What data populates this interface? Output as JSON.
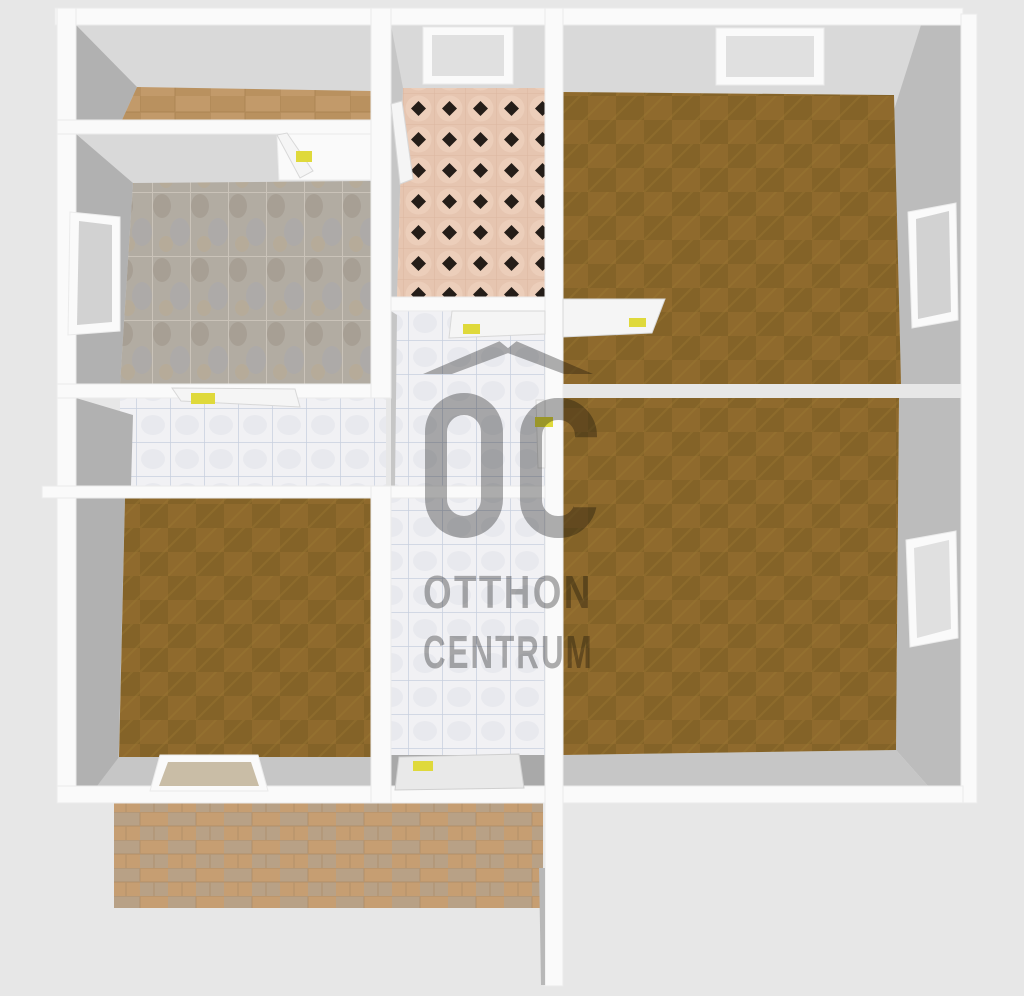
{
  "watermark": {
    "logo_text": "OC",
    "line1": "OTTHON",
    "line2": "CENTRUM"
  },
  "palette": {
    "bg": "#e7e7e7",
    "wall": "#fafafa",
    "face_light": "#d9d9d9",
    "face_mid": "#c6c6c6",
    "face_side": "#bcbcbc",
    "face_dark": "#b1b1b1",
    "wood_base": "#8f6a2d",
    "wood_dark": "#806027",
    "wood_hatch": "#9c7733",
    "woodlight_base": "#c29a6a",
    "woodlight_dark": "#b38a58",
    "woodlight_line": "#a8814f",
    "terrace_base": "#c69e72",
    "terrace_alt": "#b7a289",
    "terrace_line": "#a98a63",
    "kitchen_base": "#b2aca2",
    "kitchen_blob1": "#9e9488",
    "kitchen_blob2": "#a8a8ae",
    "kitchen_blob3": "#baa98f",
    "kitchen_grout": "#cdc6bc",
    "bath_base": "#e6c5b0",
    "bath_shade": "#f0d4c2",
    "bath_diamond": "#241d18",
    "bath_grout": "#d8b19b",
    "hall_base": "#f1f1f4",
    "hall_blob": "#e3e5ec",
    "hall_grout": "#c2cbdc",
    "door_leaf": "#f5f5f5",
    "door_edge": "#d8d8d8",
    "handle": "#dfd93b",
    "glass": "#d2d2d2",
    "glass_dark": "#e0e0e0",
    "window_tan": "#c9bda6",
    "threshold": "#a9a9a9",
    "wm_gray": "#6e6e6e"
  }
}
